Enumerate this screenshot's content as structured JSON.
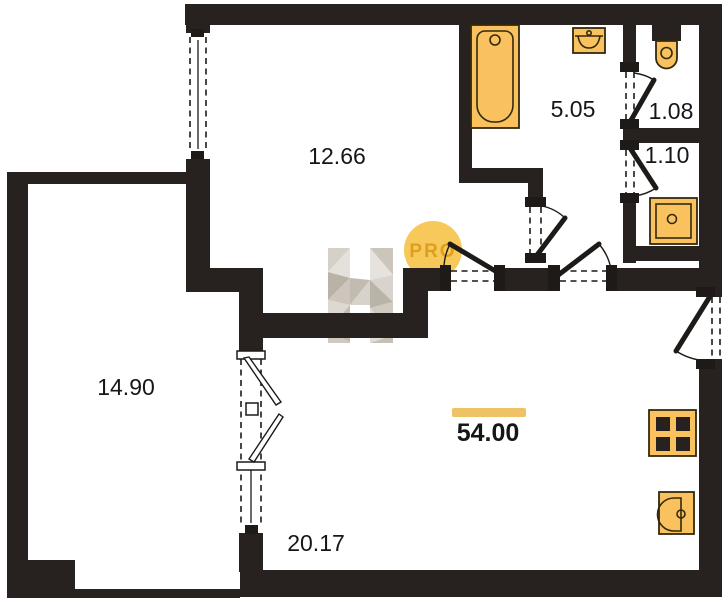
{
  "floorplan": {
    "total_area": {
      "value": "54.00"
    },
    "rooms": [
      {
        "area": "12.66"
      },
      {
        "area": "5.05"
      },
      {
        "area": "1.08"
      },
      {
        "area": "1.10"
      },
      {
        "area": "14.90"
      },
      {
        "area": "20.17"
      }
    ],
    "watermark_badge": "PRO",
    "fixtures": [
      "bathtub",
      "washbasin",
      "toilet",
      "shower-tray",
      "stove",
      "kitchen-sink"
    ]
  },
  "colors": {
    "wall": "#272220",
    "line": "#1d1a18",
    "fixture": "#F9C25E",
    "fixture-stroke": "#33290F",
    "accent-bar": "#EFC266",
    "badge-fill": "#F6C34C",
    "badge-text": "#D9960F",
    "text": "#161616",
    "bg": "#FFFFFF"
  }
}
